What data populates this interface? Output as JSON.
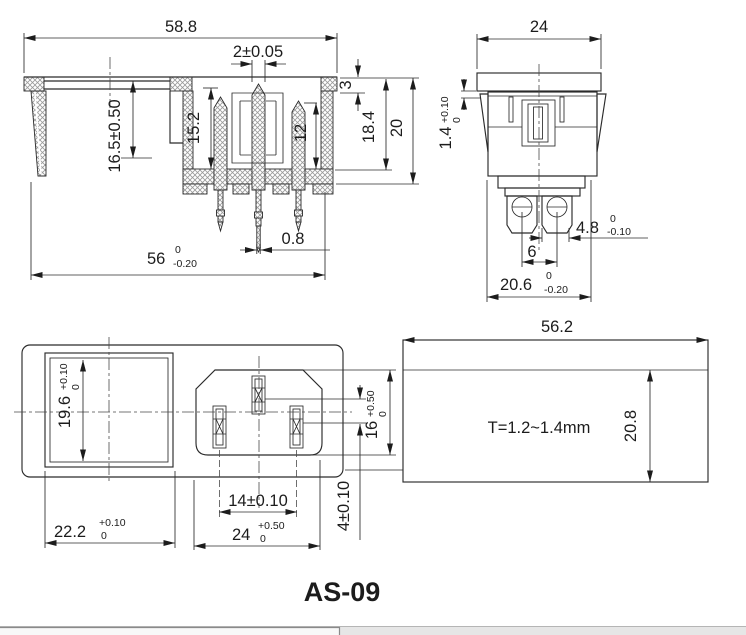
{
  "title": "AS-09",
  "side_view": {
    "d_width_top": "58.8",
    "d_pin_width": "2±0.05",
    "d_flange_step": "3",
    "d_depth_inner": "18.4",
    "d_depth_total": "20",
    "d_fuse_depth": "15.2",
    "d_pin_depth": "12",
    "d_height": "16.5±0.50",
    "d_tip_width": "0.8",
    "d_width_bottom": "56",
    "d_width_bottom_tol_up": "0",
    "d_width_bottom_tol_dn": "-0.20"
  },
  "end_view": {
    "d_width": "24",
    "d_lip": "1.4",
    "d_lip_tol_up": "+0.10",
    "d_lip_tol_dn": "0",
    "d_terminal_width": "4.8",
    "d_terminal_width_tol_up": "0",
    "d_terminal_width_tol_dn": "-0.10",
    "d_terminal_pitch": "6",
    "d_body_width": "20.6",
    "d_body_width_tol_up": "0",
    "d_body_width_tol_dn": "-0.20"
  },
  "front_view": {
    "d_window_height": "19.6",
    "d_window_height_tol_up": "+0.10",
    "d_window_height_tol_dn": "0",
    "d_window_width": "22.2",
    "d_window_width_tol_up": "+0.10",
    "d_window_width_tol_dn": "0",
    "d_pin_pitch": "14±0.10",
    "d_inlet_width": "24",
    "d_inlet_width_tol_up": "+0.50",
    "d_inlet_width_tol_dn": "0",
    "d_inlet_height": "16",
    "d_inlet_height_tol_up": "+0.50",
    "d_inlet_height_tol_dn": "0",
    "d_row_offset": "4±0.10"
  },
  "cutout_view": {
    "d_width": "56.2",
    "d_height": "20.8",
    "thickness_note": "T=1.2~1.4mm"
  },
  "colors": {
    "line": "#2b2b2b",
    "hatch": "#9a9a9a",
    "background": "#ffffff",
    "footer_bar": "#e6e6e6"
  }
}
